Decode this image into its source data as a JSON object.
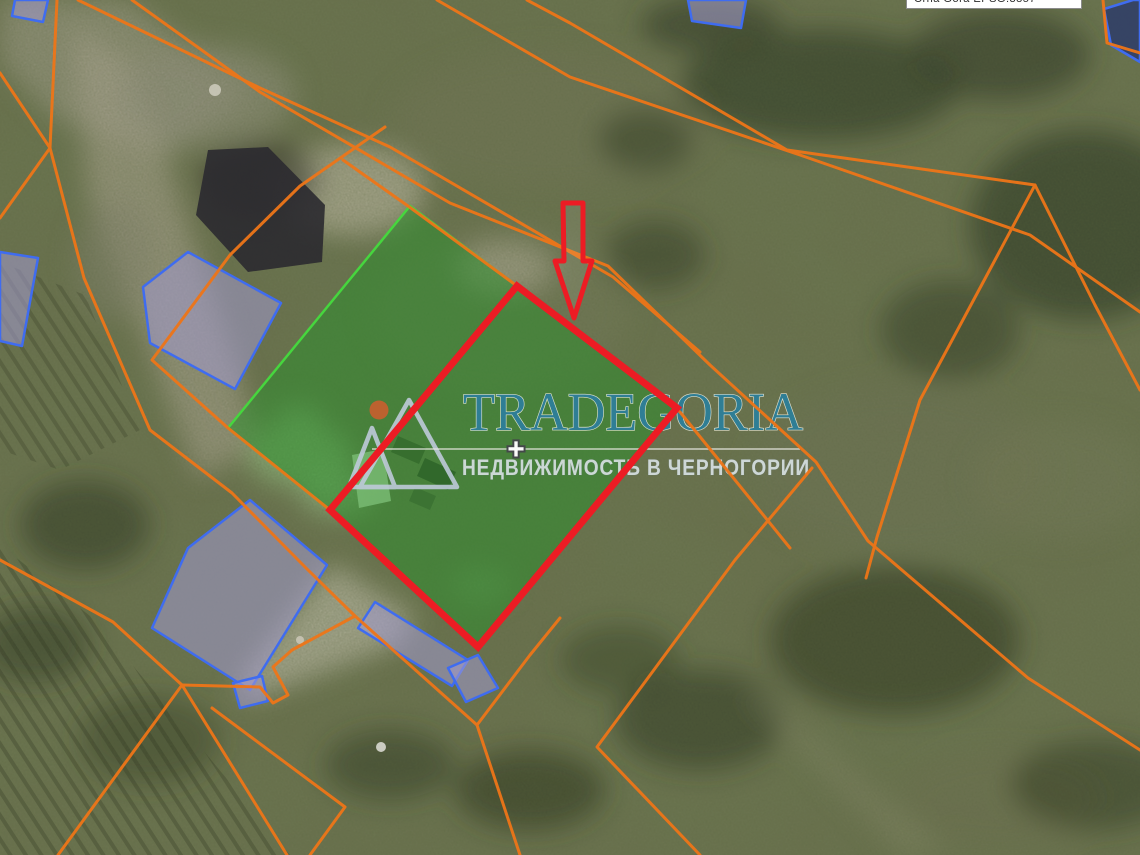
{
  "attribution": {
    "text": "Crna Gora EPSG:3857"
  },
  "watermark": {
    "title": "TRADEGORIA",
    "subtitle": "НЕДВИЖИМОСТЬ В ЧЕРНОГОРИИ",
    "divider_symbol": "+",
    "logo_icon": "mountains-sun-logo"
  },
  "theme": {
    "cadastral-line": "#ee7518",
    "building-outline": "#3f6cf0",
    "building-fill": "rgba(163,155,208,0.55)",
    "highlight-fill": "rgba(45,142,45,0.55)",
    "highlight-stroke": "#46d63e",
    "selected-stroke": "#ec1c24",
    "arrow-color": "#ec1c24",
    "watermark-teal": "#2f7e95",
    "watermark-gray": "#d7e0e2"
  }
}
